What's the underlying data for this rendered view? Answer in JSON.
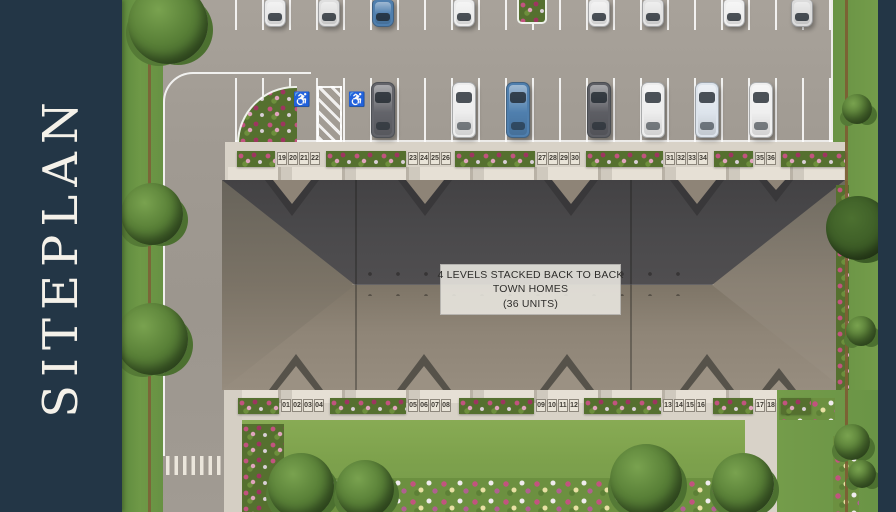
{
  "sidebar": {
    "title": "SITEPLAN",
    "bg": "#233646",
    "text_color": "#f4f1e9"
  },
  "building_label": {
    "line1": "4 LEVELS STACKED BACK TO BACK",
    "line2": "TOWN HOMES",
    "line3": "(36 UNITS)"
  },
  "icons": {
    "accessible_parking": "♿"
  },
  "palette": {
    "asphalt": "#a09a92",
    "concrete": "#d8d2c7",
    "roof_dark": "#4b4a4c",
    "roof_light": "#8f8577",
    "grass": "#6f9947",
    "lawn": "#7da14c",
    "fence": "#7d6036",
    "flower_pink": "#c2537f",
    "car_blue": "#4f7fae",
    "sidebar_navy": "#233646"
  },
  "units": {
    "top_groups": [
      {
        "x": 277,
        "numbers": [
          "19",
          "20",
          "21",
          "22"
        ]
      },
      {
        "x": 408,
        "numbers": [
          "23",
          "24",
          "25",
          "26"
        ]
      },
      {
        "x": 537,
        "numbers": [
          "27",
          "28",
          "29",
          "30"
        ]
      },
      {
        "x": 665,
        "numbers": [
          "31",
          "32",
          "33",
          "34"
        ]
      },
      {
        "x": 755,
        "numbers": [
          "35",
          "36"
        ]
      }
    ],
    "bottom_groups": [
      {
        "x": 281,
        "numbers": [
          "01",
          "02",
          "03",
          "04"
        ]
      },
      {
        "x": 408,
        "numbers": [
          "05",
          "06",
          "07",
          "08"
        ]
      },
      {
        "x": 536,
        "numbers": [
          "09",
          "10",
          "11",
          "12"
        ]
      },
      {
        "x": 663,
        "numbers": [
          "13",
          "14",
          "15",
          "16"
        ]
      },
      {
        "x": 755,
        "numbers": [
          "17",
          "18"
        ]
      }
    ]
  },
  "scene": {
    "cars_row1": [
      {
        "x": 264,
        "color": "#e9e9e9"
      },
      {
        "x": 318,
        "color": "#dfdfdf"
      },
      {
        "x": 372,
        "color": "#4f7fae"
      },
      {
        "x": 453,
        "color": "#ededed"
      },
      {
        "x": 588,
        "color": "#e9e9e9"
      },
      {
        "x": 642,
        "color": "#e2e2e2"
      },
      {
        "x": 723,
        "color": "#efefef"
      },
      {
        "x": 791,
        "color": "#dcdcdc"
      }
    ],
    "cars_row2": [
      {
        "x": 371,
        "color": "#63646a"
      },
      {
        "x": 452,
        "color": "#ededed"
      },
      {
        "x": 506,
        "color": "#4f7fae"
      },
      {
        "x": 587,
        "color": "#5d5e64"
      },
      {
        "x": 641,
        "color": "#ededed"
      },
      {
        "x": 695,
        "color": "#dde4ec"
      },
      {
        "x": 749,
        "color": "#efefef"
      }
    ],
    "planters_top": [
      [
        237,
        38
      ],
      [
        326,
        80
      ],
      [
        455,
        80
      ],
      [
        586,
        77
      ],
      [
        714,
        39
      ],
      [
        781,
        64
      ]
    ],
    "planters_bottom": [
      [
        238,
        41
      ],
      [
        330,
        76
      ],
      [
        459,
        75
      ],
      [
        584,
        77
      ],
      [
        713,
        40
      ],
      [
        781,
        30
      ]
    ],
    "gables_top": [
      {
        "c": 292,
        "w": 54,
        "h": 36
      },
      {
        "c": 425,
        "w": 54,
        "h": 36
      },
      {
        "c": 571,
        "w": 54,
        "h": 36
      },
      {
        "c": 697,
        "w": 54,
        "h": 36
      },
      {
        "c": 776,
        "w": 34,
        "h": 22
      }
    ],
    "gables_bottom": [
      {
        "c": 296,
        "w": 54,
        "h": 36
      },
      {
        "c": 424,
        "w": 54,
        "h": 36
      },
      {
        "c": 567,
        "w": 54,
        "h": 36
      },
      {
        "c": 707,
        "w": 54,
        "h": 36
      },
      {
        "c": 779,
        "w": 34,
        "h": 22
      }
    ],
    "trees": [
      {
        "x": 128,
        "y": -16,
        "d": 80
      },
      {
        "x": 121,
        "y": 183,
        "d": 62
      },
      {
        "x": 116,
        "y": 303,
        "d": 72
      },
      {
        "x": 268,
        "y": 453,
        "d": 66
      },
      {
        "x": 336,
        "y": 460,
        "d": 58
      },
      {
        "x": 610,
        "y": 444,
        "d": 72
      },
      {
        "x": 712,
        "y": 453,
        "d": 62
      },
      {
        "x": 826,
        "y": 196,
        "d": 64,
        "dark": true
      },
      {
        "x": 842,
        "y": 94,
        "d": 30
      },
      {
        "x": 846,
        "y": 316,
        "d": 30
      },
      {
        "x": 834,
        "y": 424,
        "d": 36
      },
      {
        "x": 848,
        "y": 460,
        "d": 28
      }
    ]
  }
}
